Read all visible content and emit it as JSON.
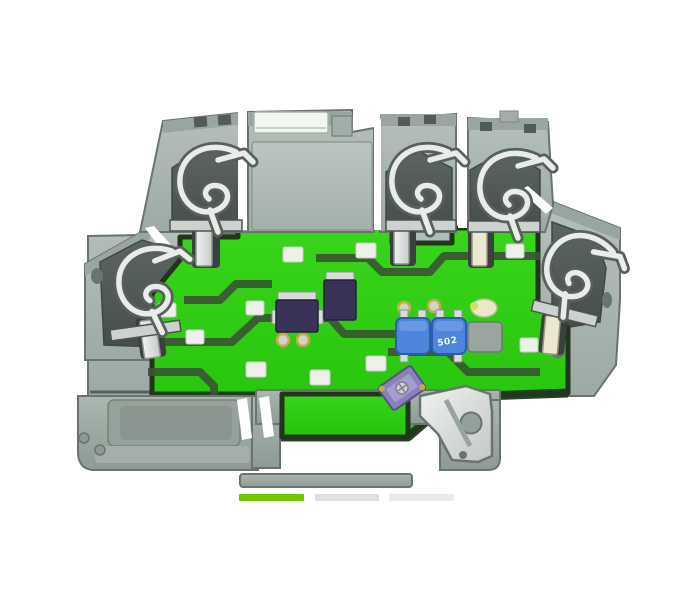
{
  "page": {
    "background": "#ffffff"
  },
  "colors": {
    "housing_gray": "#a9b5b0",
    "housing_light": "#bcc6c1",
    "housing_mid": "#9aa6a0",
    "housing_dark": "#57605b",
    "recess_dark": "#4e5753",
    "pcb_green": "#2fd012",
    "pcb_green_deep": "#27c20c",
    "pcb_trace": "#3a5334",
    "pcb_edge": "#20351a",
    "pad_white": "#eef0ea",
    "metal_light": "#e9ece8",
    "metal_mid": "#cdd2ce",
    "component_navy": "#39335a",
    "trimmer_blue": "#4d86dc",
    "trimmer_blue_dark": "#2a5cb0",
    "latch_purple": "#8b80b9",
    "marker_green": "#74c600",
    "indicator_gray_1": "#dce0df",
    "indicator_gray_2": "#e8ebea"
  },
  "product_photo": {
    "subject": "gray DIN-rail terminal block, cut-away view with green PCB, spring clamps and electronics",
    "pcb": {
      "trimmer_label": "502"
    }
  },
  "carousel": {
    "indicators": [
      {
        "id": "slide-1",
        "active": true
      },
      {
        "id": "slide-2",
        "active": false
      },
      {
        "id": "slide-3",
        "active": false
      }
    ]
  }
}
